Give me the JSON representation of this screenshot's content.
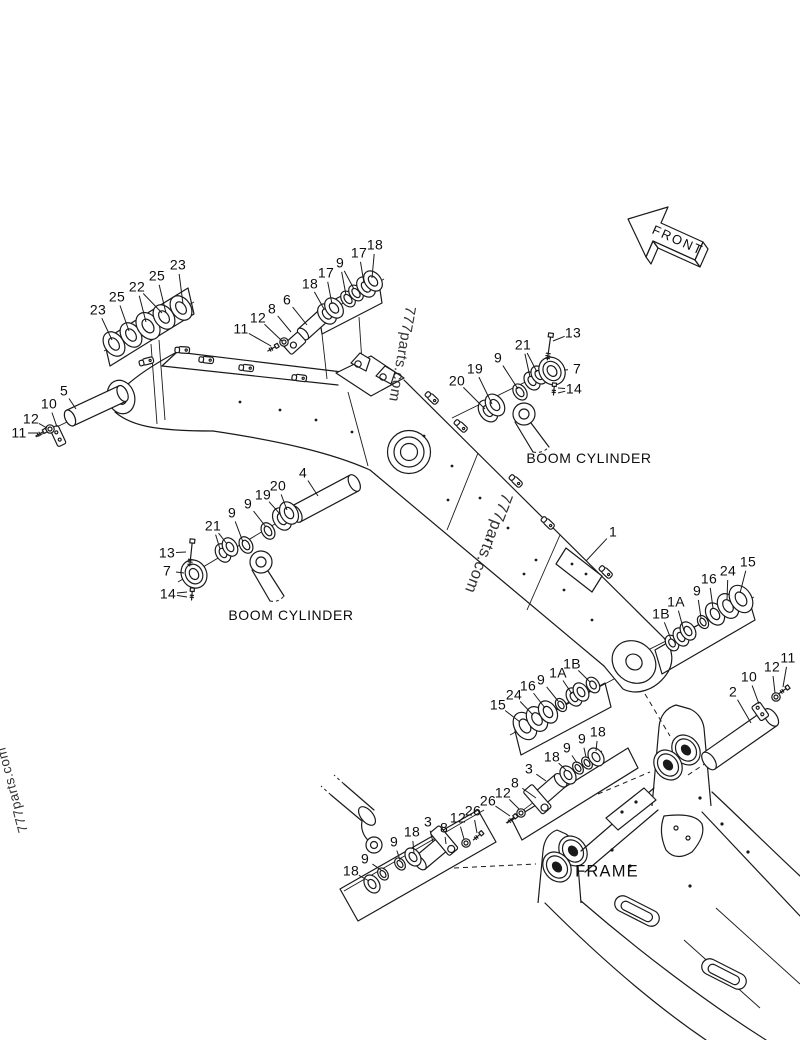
{
  "page": {
    "background": "#ffffff",
    "ink": "#1a1a1a"
  },
  "front_arrow": {
    "label": "FRONT"
  },
  "area_labels": [
    {
      "text": "BOOM CYLINDER",
      "name": "boom-cylinder-label-upper",
      "x": 589,
      "y": 458
    },
    {
      "text": "BOOM CYLINDER",
      "name": "boom-cylinder-label-lower",
      "x": 291,
      "y": 615
    },
    {
      "text": "FRAME",
      "name": "frame-label",
      "x": 607,
      "y": 872
    }
  ],
  "watermarks": [
    {
      "text": "777parts.com",
      "name": "watermark-left",
      "x": 12,
      "y": 790,
      "rotation": -105
    },
    {
      "text": "777parts.com",
      "name": "watermark-upper",
      "x": 402,
      "y": 354,
      "rotation": 100
    },
    {
      "text": "777parts.com",
      "name": "watermark-lower",
      "x": 488,
      "y": 543,
      "rotation": 111
    }
  ],
  "callouts": [
    {
      "t": "23",
      "x": 98,
      "y": 310,
      "lx": 112,
      "ly": 340
    },
    {
      "t": "25",
      "x": 117,
      "y": 297,
      "lx": 129,
      "ly": 331
    },
    {
      "t": "22",
      "x": 137,
      "y": 287,
      "lx": 146,
      "ly": 322,
      "l2x": 162,
      "l2y": 313
    },
    {
      "t": "25",
      "x": 157,
      "y": 276,
      "lx": 166,
      "ly": 313
    },
    {
      "t": "23",
      "x": 178,
      "y": 265,
      "lx": 183,
      "ly": 304
    },
    {
      "t": "11",
      "x": 241,
      "y": 329,
      "lx": 271,
      "ly": 346
    },
    {
      "t": "12",
      "x": 258,
      "y": 318,
      "lx": 282,
      "ly": 341
    },
    {
      "t": "8",
      "x": 272,
      "y": 309,
      "lx": 291,
      "ly": 332
    },
    {
      "t": "6",
      "x": 287,
      "y": 300,
      "lx": 307,
      "ly": 325
    },
    {
      "t": "18",
      "x": 310,
      "y": 284,
      "lx": 324,
      "ly": 309
    },
    {
      "t": "17",
      "x": 326,
      "y": 273,
      "lx": 332,
      "ly": 304
    },
    {
      "t": "9",
      "x": 340,
      "y": 263,
      "lx": 346,
      "ly": 295,
      "l2x": 354,
      "l2y": 289
    },
    {
      "t": "17",
      "x": 359,
      "y": 253,
      "lx": 364,
      "ly": 283
    },
    {
      "t": "18",
      "x": 375,
      "y": 245,
      "lx": 372,
      "ly": 278
    },
    {
      "t": "20",
      "x": 457,
      "y": 381,
      "lx": 485,
      "ly": 409
    },
    {
      "t": "19",
      "x": 475,
      "y": 369,
      "lx": 492,
      "ly": 404
    },
    {
      "t": "9",
      "x": 498,
      "y": 358,
      "lx": 518,
      "ly": 389
    },
    {
      "t": "21",
      "x": 523,
      "y": 345,
      "lx": 530,
      "ly": 377,
      "l2x": 537,
      "l2y": 372
    },
    {
      "t": "13",
      "x": 573,
      "y": 333,
      "lx": 553,
      "ly": 341
    },
    {
      "t": "7",
      "x": 577,
      "y": 369,
      "lx": 564,
      "ly": 370
    },
    {
      "t": "14",
      "x": 574,
      "y": 389,
      "lx": 558,
      "ly": 388,
      "l2x": 558,
      "l2y": 393
    },
    {
      "t": "5",
      "x": 64,
      "y": 391,
      "lx": 76,
      "ly": 409
    },
    {
      "t": "10",
      "x": 49,
      "y": 404,
      "lx": 57,
      "ly": 427
    },
    {
      "t": "12",
      "x": 31,
      "y": 419,
      "lx": 47,
      "ly": 428
    },
    {
      "t": "11",
      "x": 19,
      "y": 433,
      "lx": 38,
      "ly": 433
    },
    {
      "t": "4",
      "x": 303,
      "y": 473,
      "lx": 318,
      "ly": 496
    },
    {
      "t": "20",
      "x": 278,
      "y": 486,
      "lx": 287,
      "ly": 510
    },
    {
      "t": "19",
      "x": 263,
      "y": 495,
      "lx": 280,
      "ly": 514
    },
    {
      "t": "9",
      "x": 248,
      "y": 504,
      "lx": 266,
      "ly": 527
    },
    {
      "t": "9",
      "x": 232,
      "y": 513,
      "lx": 243,
      "ly": 542
    },
    {
      "t": "21",
      "x": 213,
      "y": 526,
      "lx": 220,
      "ly": 549,
      "l2x": 227,
      "l2y": 544
    },
    {
      "t": "13",
      "x": 167,
      "y": 553,
      "lx": 186,
      "ly": 552
    },
    {
      "t": "7",
      "x": 167,
      "y": 571,
      "lx": 184,
      "ly": 573
    },
    {
      "t": "14",
      "x": 168,
      "y": 594,
      "lx": 187,
      "ly": 592,
      "l2x": 187,
      "l2y": 597
    },
    {
      "t": "1",
      "x": 613,
      "y": 532,
      "lx": 586,
      "ly": 561
    },
    {
      "t": "1B",
      "x": 661,
      "y": 614,
      "lx": 671,
      "ly": 639
    },
    {
      "t": "1A",
      "x": 676,
      "y": 602,
      "lx": 684,
      "ly": 631
    },
    {
      "t": "9",
      "x": 697,
      "y": 591,
      "lx": 701,
      "ly": 618
    },
    {
      "t": "16",
      "x": 709,
      "y": 579,
      "lx": 713,
      "ly": 608
    },
    {
      "t": "24",
      "x": 728,
      "y": 571,
      "lx": 727,
      "ly": 600
    },
    {
      "t": "15",
      "x": 748,
      "y": 562,
      "lx": 740,
      "ly": 593
    },
    {
      "t": "15",
      "x": 498,
      "y": 705,
      "lx": 520,
      "ly": 722
    },
    {
      "t": "24",
      "x": 514,
      "y": 695,
      "lx": 533,
      "ly": 715
    },
    {
      "t": "16",
      "x": 528,
      "y": 686,
      "lx": 545,
      "ly": 708
    },
    {
      "t": "9",
      "x": 541,
      "y": 680,
      "lx": 558,
      "ly": 701
    },
    {
      "t": "1A",
      "x": 558,
      "y": 673,
      "lx": 572,
      "ly": 694
    },
    {
      "t": "1B",
      "x": 572,
      "y": 664,
      "lx": 590,
      "ly": 682
    },
    {
      "t": "2",
      "x": 733,
      "y": 692,
      "lx": 751,
      "ly": 723
    },
    {
      "t": "10",
      "x": 749,
      "y": 677,
      "lx": 759,
      "ly": 704
    },
    {
      "t": "12",
      "x": 772,
      "y": 667,
      "lx": 775,
      "ly": 693
    },
    {
      "t": "11",
      "x": 788,
      "y": 658,
      "lx": 783,
      "ly": 687
    },
    {
      "t": "18",
      "x": 598,
      "y": 732,
      "lx": 596,
      "ly": 751
    },
    {
      "t": "9",
      "x": 582,
      "y": 739,
      "lx": 586,
      "ly": 757
    },
    {
      "t": "9",
      "x": 567,
      "y": 748,
      "lx": 577,
      "ly": 763
    },
    {
      "t": "18",
      "x": 552,
      "y": 757,
      "lx": 566,
      "ly": 770
    },
    {
      "t": "3",
      "x": 529,
      "y": 769,
      "lx": 546,
      "ly": 781
    },
    {
      "t": "8",
      "x": 515,
      "y": 783,
      "lx": 536,
      "ly": 798
    },
    {
      "t": "12",
      "x": 503,
      "y": 793,
      "lx": 519,
      "ly": 809
    },
    {
      "t": "26",
      "x": 488,
      "y": 801,
      "lx": 510,
      "ly": 816
    },
    {
      "t": "26",
      "x": 473,
      "y": 811,
      "lx": 477,
      "ly": 833
    },
    {
      "t": "12",
      "x": 458,
      "y": 818,
      "lx": 464,
      "ly": 839
    },
    {
      "t": "8",
      "x": 444,
      "y": 828,
      "lx": 446,
      "ly": 844
    },
    {
      "t": "3",
      "x": 428,
      "y": 822,
      "lx": 433,
      "ly": 842
    },
    {
      "t": "18",
      "x": 412,
      "y": 832,
      "lx": 414,
      "ly": 853
    },
    {
      "t": "9",
      "x": 394,
      "y": 842,
      "lx": 400,
      "ly": 860
    },
    {
      "t": "9",
      "x": 365,
      "y": 859,
      "lx": 381,
      "ly": 870
    },
    {
      "t": "18",
      "x": 351,
      "y": 871,
      "lx": 369,
      "ly": 881
    }
  ]
}
